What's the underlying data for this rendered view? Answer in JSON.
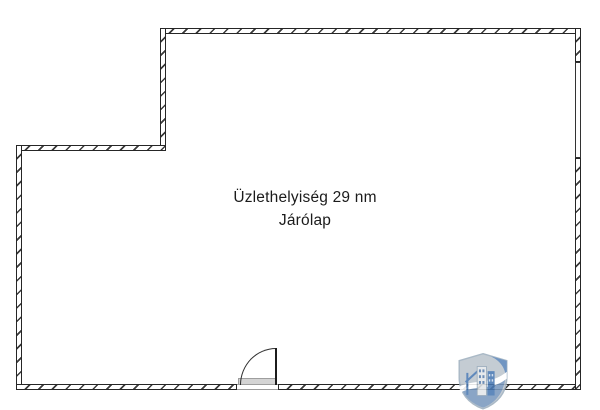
{
  "image": {
    "type": "floor-plan",
    "background": "#ffffff"
  },
  "floor_plan": {
    "room_label_line1": "Üzlethelyiség 29 nm",
    "room_label_line2": "Járólap",
    "features": [
      "door-swing-bottom-wall",
      "window-right-wall",
      "stepped-top-left-corner"
    ],
    "wall_outline_color": "#262626",
    "wall_hatch_color": "#3a3a3a",
    "door_sill_color": "#d4d4d4",
    "threshold_line_color": "#9b9b9b"
  },
  "watermark": {
    "name": "shield-buildings-logo",
    "shield_fill": "#bcc5ce",
    "shield_bottom_blue": "#7a99bf",
    "building_blue": "#4a79b3",
    "building_light": "#e3e7ea",
    "accent_white": "#ffffff"
  }
}
